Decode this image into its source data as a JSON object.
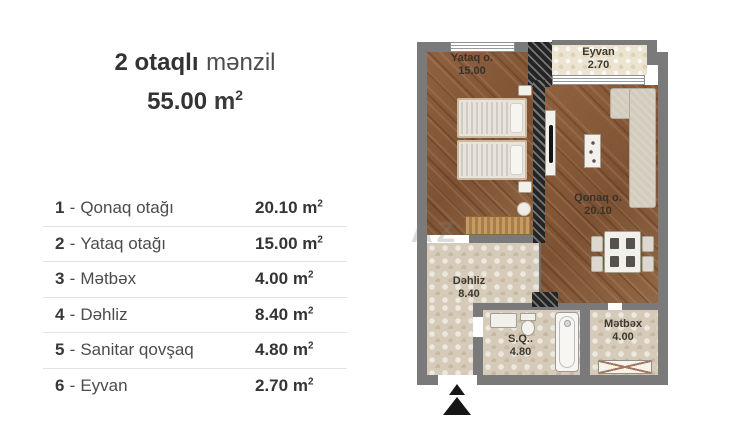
{
  "title": {
    "part_bold": "2 otaqlı",
    "part_regular": "mənzil",
    "area": "55.00",
    "unit": "m",
    "sup": "2"
  },
  "legend": {
    "dash": "-",
    "unit": "m",
    "sup": "2",
    "rows": [
      {
        "num": "1",
        "name": "Qonaq otağı",
        "value": "20.10"
      },
      {
        "num": "2",
        "name": "Yataq otağı",
        "value": "15.00"
      },
      {
        "num": "3",
        "name": "Mətbəx",
        "value": "4.00"
      },
      {
        "num": "4",
        "name": "Dəhliz",
        "value": "8.40"
      },
      {
        "num": "5",
        "name": "Sanitar qovşaq",
        "value": "4.80"
      },
      {
        "num": "6",
        "name": "Eyvan",
        "value": "2.70"
      }
    ]
  },
  "plan": {
    "watermark": "AZ",
    "rooms": [
      {
        "key": "yataq",
        "label": "Yataq o.",
        "area": "15.00"
      },
      {
        "key": "eyvan",
        "label": "Eyvan",
        "area": "2.70"
      },
      {
        "key": "qonaq",
        "label": "Qonaq o.",
        "area": "20.10"
      },
      {
        "key": "dehliz",
        "label": "Dəhliz",
        "area": "8.40"
      },
      {
        "key": "sq",
        "label": "S.Q..",
        "area": "4.80"
      },
      {
        "key": "metbex",
        "label": "Mətbəx",
        "area": "4.00"
      }
    ],
    "colors": {
      "wall": "#7a7a7a",
      "wood_floor": "#8a5c3a",
      "tile_floor": "#d6cbb8",
      "balcony_tile": "#ece4d1",
      "hatch": "#242424",
      "text": "#37322b"
    }
  }
}
